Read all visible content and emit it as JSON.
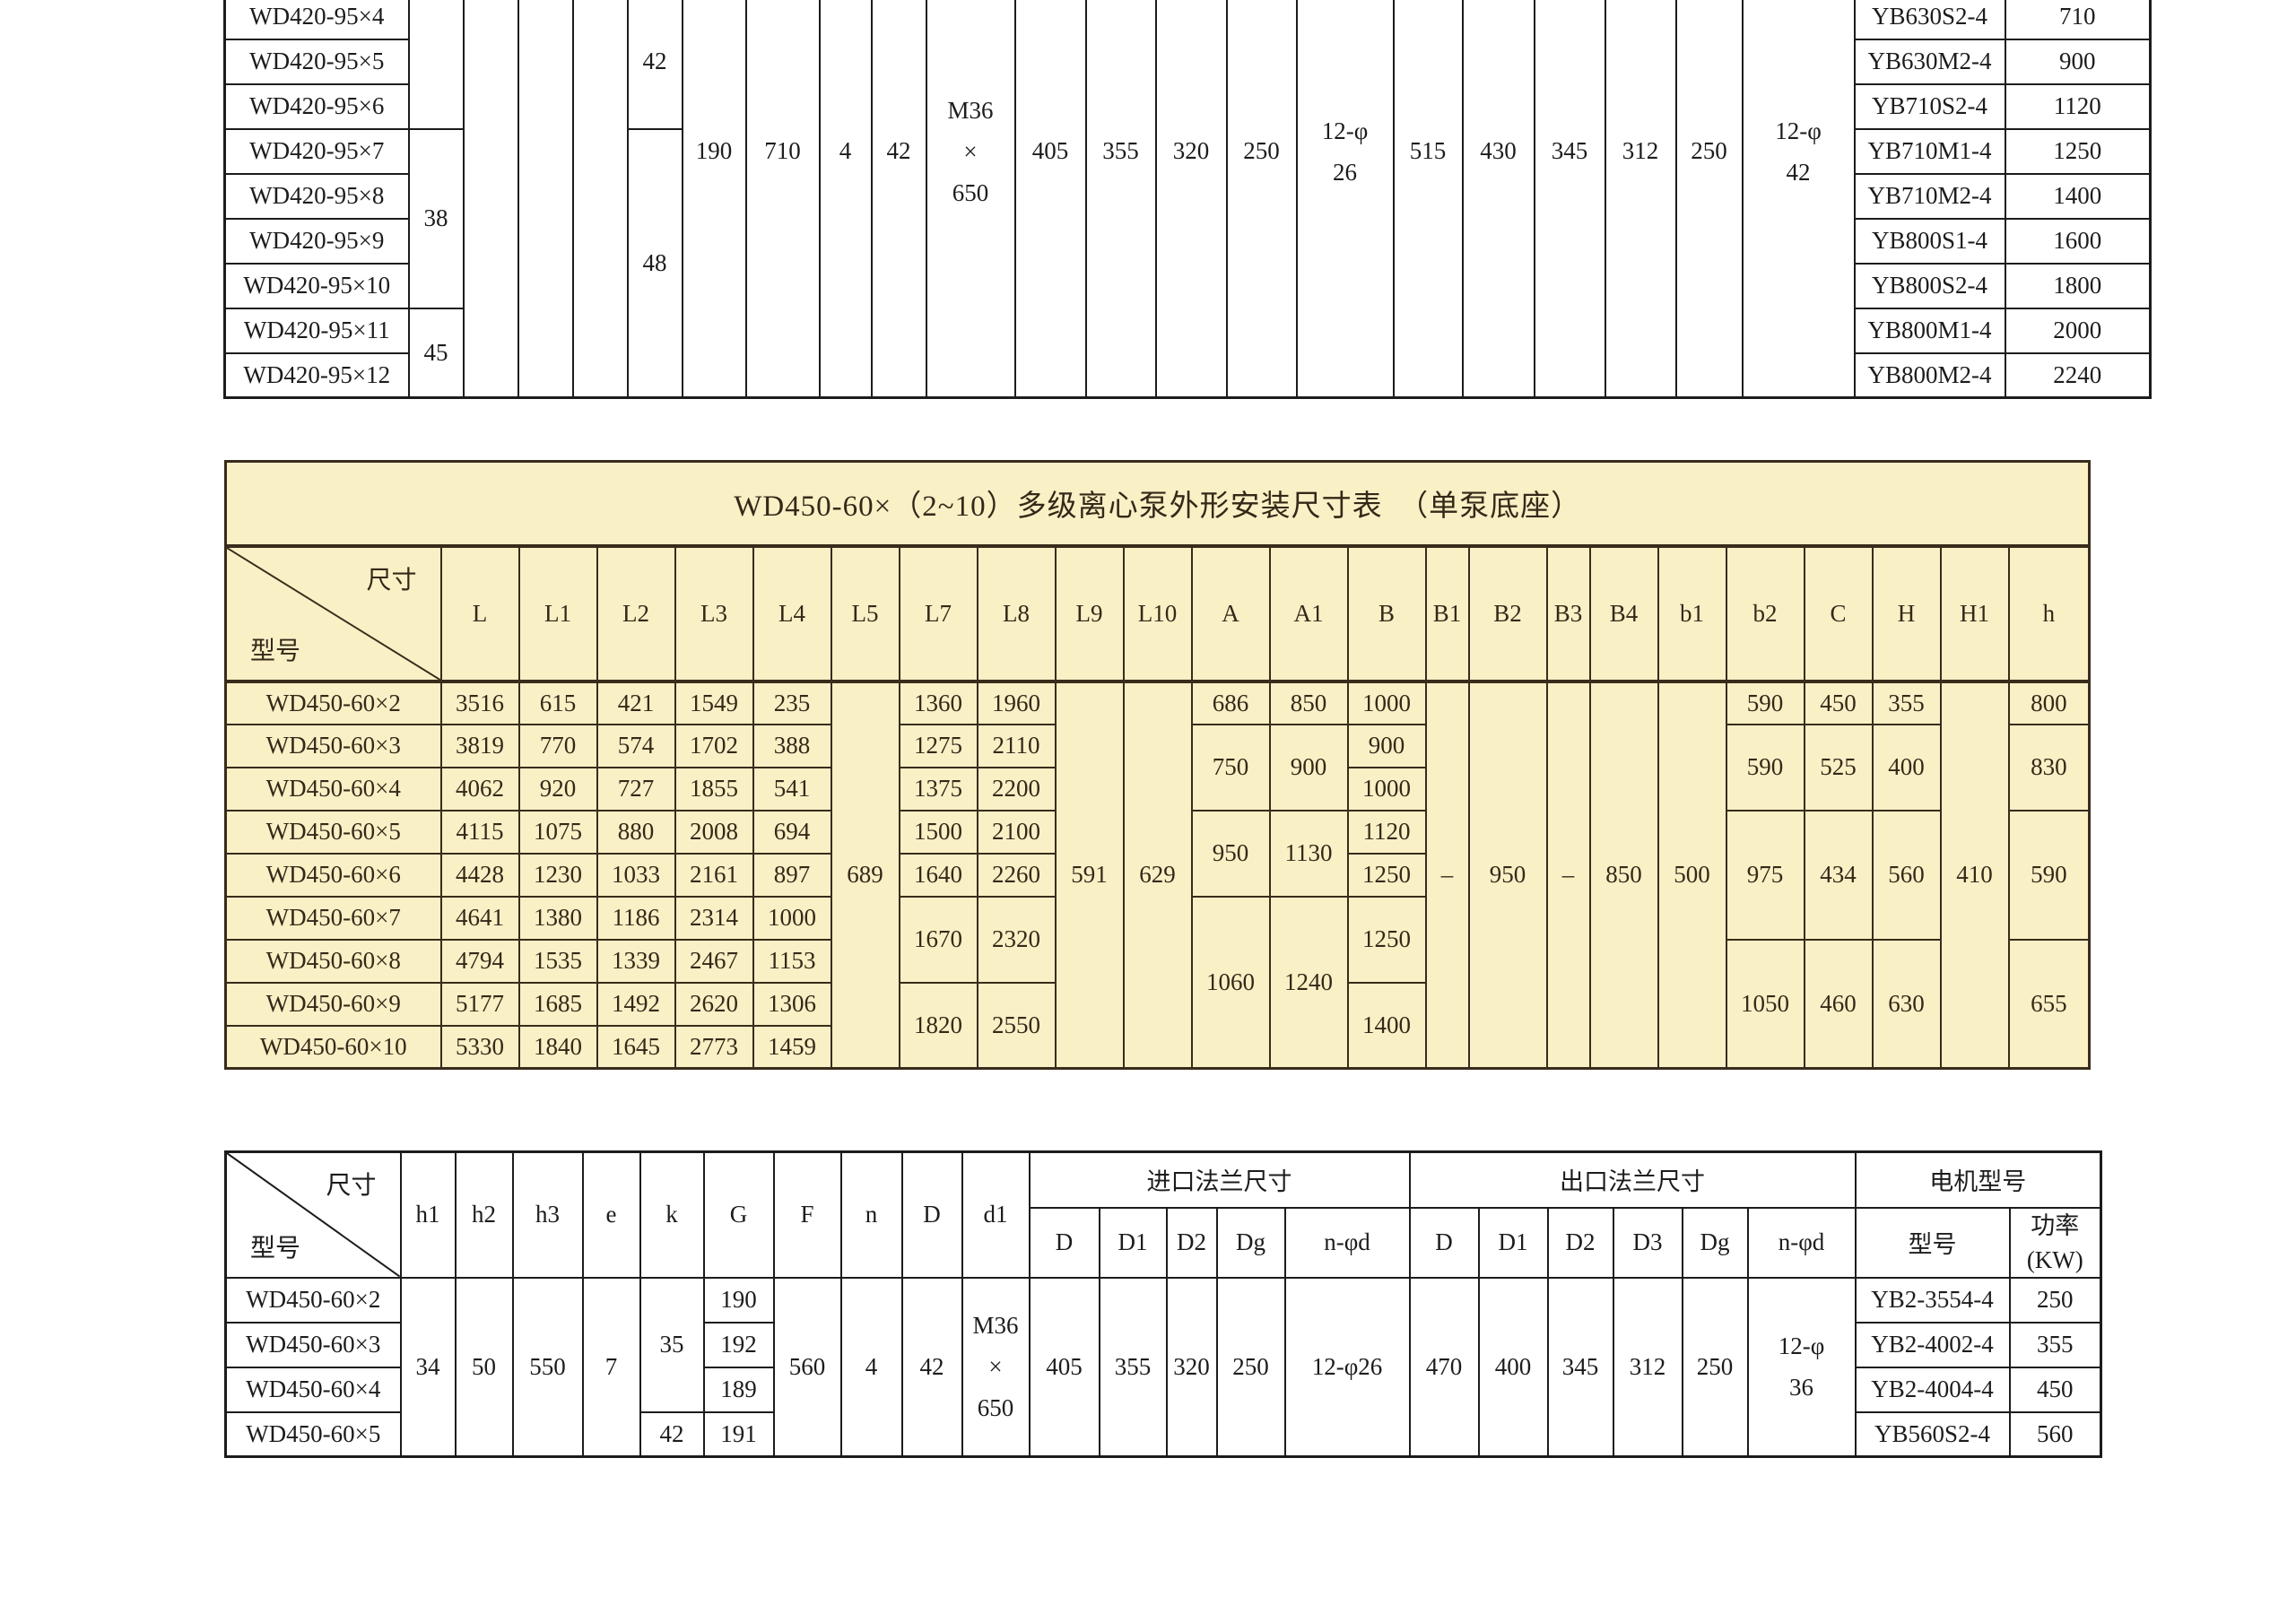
{
  "top": {
    "models": [
      "WD420-95×4",
      "WD420-95×5",
      "WD420-95×6",
      "WD420-95×7",
      "WD420-95×8",
      "WD420-95×9",
      "WD420-95×10",
      "WD420-95×11",
      "WD420-95×12"
    ],
    "h1_upper": "38",
    "h1_lower": "45",
    "k_upper": "42",
    "k_lower": "48",
    "G": "190",
    "F": "710",
    "n": "4",
    "D": "42",
    "d1": [
      "M36",
      "×",
      "650"
    ],
    "inlet": {
      "D": "405",
      "D1": "355",
      "D2": "320",
      "Dg": "250",
      "nphid": [
        "12-φ",
        "26"
      ]
    },
    "outlet": {
      "D": "515",
      "D1": "430",
      "D2": "345",
      "D3": "312",
      "Dg": "250",
      "nphid": [
        "12-φ",
        "42"
      ]
    },
    "motors": [
      {
        "model": "YB630S2-4",
        "power": "710"
      },
      {
        "model": "YB630M2-4",
        "power": "900"
      },
      {
        "model": "YB710S2-4",
        "power": "1120"
      },
      {
        "model": "YB710M1-4",
        "power": "1250"
      },
      {
        "model": "YB710M2-4",
        "power": "1400"
      },
      {
        "model": "YB800S1-4",
        "power": "1600"
      },
      {
        "model": "YB800S2-4",
        "power": "1800"
      },
      {
        "model": "YB800M1-4",
        "power": "2000"
      },
      {
        "model": "YB800M2-4",
        "power": "2240"
      }
    ]
  },
  "mid": {
    "title": "WD450-60×（2~10）多级离心泵外形安装尺寸表　（单泵底座）",
    "corner_top": "尺寸",
    "corner_bottom": "型号",
    "headers": [
      "L",
      "L1",
      "L2",
      "L3",
      "L4",
      "L5",
      "L7",
      "L8",
      "L9",
      "L10",
      "A",
      "A1",
      "B",
      "B1",
      "B2",
      "B3",
      "B4",
      "b1",
      "b2",
      "C",
      "H",
      "H1",
      "h"
    ],
    "span_all": {
      "L5": "689",
      "L9": "591",
      "L10": "629",
      "B1": "–",
      "B2": "950",
      "B3": "–",
      "B4": "850",
      "b1": "500",
      "H1": "410"
    },
    "rows": [
      {
        "model": "WD450-60×2",
        "L": "3516",
        "L1": "615",
        "L2": "421",
        "L3": "1549",
        "L4": "235",
        "L7": "1360",
        "L8": "1960",
        "A": "686",
        "A1": "850",
        "B": "1000",
        "b2": "590",
        "C": "450",
        "H": "355",
        "h": "800"
      },
      {
        "model": "WD450-60×3",
        "L": "3819",
        "L1": "770",
        "L2": "574",
        "L3": "1702",
        "L4": "388",
        "L7": "1275",
        "L8": "2110",
        "A": "750",
        "A1": "900",
        "B": "900",
        "b2": "590",
        "C": "525",
        "H": "400",
        "h": "830"
      },
      {
        "model": "WD450-60×4",
        "L": "4062",
        "L1": "920",
        "L2": "727",
        "L3": "1855",
        "L4": "541",
        "L7": "1375",
        "L8": "2200",
        "B": "1000"
      },
      {
        "model": "WD450-60×5",
        "L": "4115",
        "L1": "1075",
        "L2": "880",
        "L3": "2008",
        "L4": "694",
        "L7": "1500",
        "L8": "2100",
        "A": "950",
        "A1": "1130",
        "B": "1120",
        "b2": "975",
        "C": "434",
        "H": "560",
        "h": "590"
      },
      {
        "model": "WD450-60×6",
        "L": "4428",
        "L1": "1230",
        "L2": "1033",
        "L3": "2161",
        "L4": "897",
        "L7": "1640",
        "L8": "2260",
        "B": "1250"
      },
      {
        "model": "WD450-60×7",
        "L": "4641",
        "L1": "1380",
        "L2": "1186",
        "L3": "2314",
        "L4": "1000",
        "L7": "1670",
        "L8": "2320",
        "A": "1060",
        "A1": "1240",
        "B": "1250"
      },
      {
        "model": "WD450-60×8",
        "L": "4794",
        "L1": "1535",
        "L2": "1339",
        "L3": "2467",
        "L4": "1153",
        "b2": "1050",
        "C": "460",
        "H": "630",
        "h": "655"
      },
      {
        "model": "WD450-60×9",
        "L": "5177",
        "L1": "1685",
        "L2": "1492",
        "L3": "2620",
        "L4": "1306",
        "L7": "1820",
        "L8": "2550",
        "B": "1400"
      },
      {
        "model": "WD450-60×10",
        "L": "5330",
        "L1": "1840",
        "L2": "1645",
        "L3": "2773",
        "L4": "1459"
      }
    ]
  },
  "bot": {
    "corner_top": "尺寸",
    "corner_bottom": "型号",
    "col_headers": {
      "h1": "h1",
      "h2": "h2",
      "h3": "h3",
      "e": "e",
      "k": "k",
      "G": "G",
      "F": "F",
      "n": "n",
      "D": "D",
      "d1": "d1"
    },
    "groups": {
      "inlet": "进口法兰尺寸",
      "outlet": "出口法兰尺寸",
      "motor": "电机型号"
    },
    "inlet_headers": [
      "D",
      "D1",
      "D2",
      "Dg",
      "n-φd"
    ],
    "outlet_headers": [
      "D",
      "D1",
      "D2",
      "D3",
      "Dg",
      "n-φd"
    ],
    "motor_headers": {
      "model": "型号",
      "power_l1": "功率",
      "power_l2": "(KW)"
    },
    "models": [
      "WD450-60×2",
      "WD450-60×3",
      "WD450-60×4",
      "WD450-60×5"
    ],
    "h1": "34",
    "h2": "50",
    "h3": "550",
    "e": "7",
    "k_upper": "35",
    "k_lower": "42",
    "G": [
      "190",
      "192",
      "189",
      "191"
    ],
    "F": "560",
    "n": "4",
    "D": "42",
    "d1": [
      "M36",
      "×",
      "650"
    ],
    "inlet": {
      "D": "405",
      "D1": "355",
      "D2": "320",
      "Dg": "250",
      "nphid": "12-φ26"
    },
    "outlet": {
      "D": "470",
      "D1": "400",
      "D2": "345",
      "D3": "312",
      "Dg": "250",
      "nphid": [
        "12-φ",
        "36"
      ]
    },
    "motors": [
      {
        "model": "YB2-3554-4",
        "power": "250"
      },
      {
        "model": "YB2-4002-4",
        "power": "355"
      },
      {
        "model": "YB2-4004-4",
        "power": "450"
      },
      {
        "model": "YB560S2-4",
        "power": "560"
      }
    ]
  }
}
